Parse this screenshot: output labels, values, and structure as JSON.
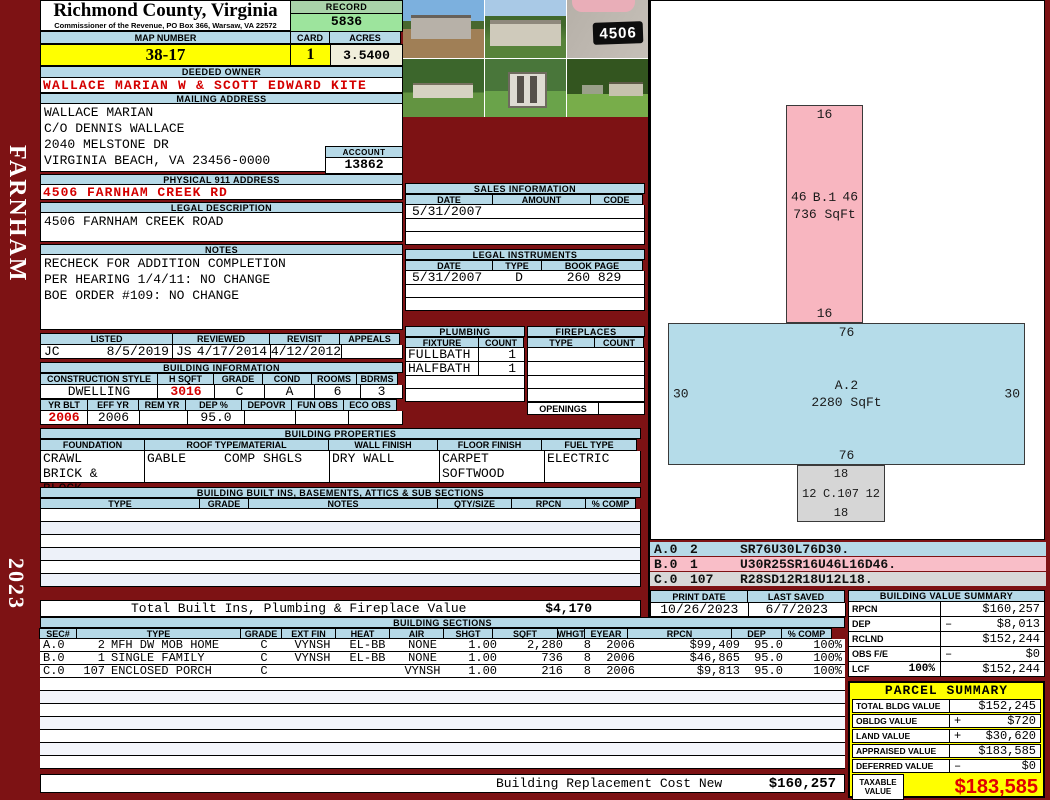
{
  "sidebar": {
    "district": "FARNHAM",
    "year": "2023"
  },
  "header": {
    "county": "Richmond County, Virginia",
    "commissioner": "Commissioner of the Revenue, PO Box 366, Warsaw, VA 22572",
    "record_label": "RECORD",
    "record": "5836",
    "map_number_label": "MAP NUMBER",
    "map_number": "38-17",
    "card_label": "CARD",
    "card": "1",
    "acres_label": "ACRES",
    "acres": "3.5400"
  },
  "owner": {
    "deeded_owner_label": "DEEDED OWNER",
    "deeded_owner": "WALLACE MARIAN W & SCOTT EDWARD KITE",
    "mailing_address_label": "MAILING ADDRESS",
    "mailing_lines": [
      "WALLACE MARIAN",
      "C/O DENNIS WALLACE",
      "2040 MELSTONE DR",
      "VIRGINIA BEACH, VA 23456-0000"
    ],
    "account_label": "ACCOUNT",
    "account": "13862",
    "physical_address_label": "PHYSICAL 911 ADDRESS",
    "physical_address": "4506 FARNHAM CREEK RD",
    "legal_description_label": "LEGAL DESCRIPTION",
    "legal_description": "4506 FARNHAM CREEK ROAD",
    "notes_label": "NOTES",
    "notes": [
      "RECHECK FOR ADDITION COMPLETION",
      "PER HEARING 1/4/11: NO CHANGE",
      "BOE ORDER #109: NO CHANGE"
    ]
  },
  "photos": {
    "sign_number": "4506"
  },
  "sales": {
    "title": "SALES INFORMATION",
    "headers": [
      "DATE",
      "AMOUNT",
      "CODE"
    ],
    "rows": [
      {
        "date": "5/31/2007",
        "amount": "",
        "code": ""
      }
    ]
  },
  "legal_instruments": {
    "title": "LEGAL INSTRUMENTS",
    "headers": [
      "DATE",
      "TYPE",
      "BOOK PAGE"
    ],
    "rows": [
      {
        "date": "5/31/2007",
        "type": "D",
        "book_page": "260 829"
      }
    ]
  },
  "plumbing": {
    "title": "PLUMBING",
    "headers": [
      "FIXTURE",
      "COUNT"
    ],
    "rows": [
      {
        "fixture": "FULLBATH",
        "count": "1"
      },
      {
        "fixture": "HALFBATH",
        "count": "1"
      }
    ]
  },
  "fireplaces": {
    "title": "FIREPLACES",
    "headers": [
      "TYPE",
      "COUNT"
    ],
    "openings_label": "OPENINGS"
  },
  "visits": {
    "headers": [
      "LISTED",
      "REVIEWED",
      "REVISIT",
      "APPEALS"
    ],
    "listed_by": "JC",
    "listed_date": "8/5/2019",
    "reviewed_by": "JS",
    "reviewed_date": "4/17/2014",
    "revisit_date": "4/12/2012",
    "appeals": ""
  },
  "building_info": {
    "title": "BUILDING INFORMATION",
    "row1_headers": [
      "CONSTRUCTION STYLE",
      "H SQFT",
      "GRADE",
      "COND",
      "ROOMS",
      "BDRMS"
    ],
    "style": "DWELLING",
    "hsqft": "3016",
    "grade": "C",
    "cond": "A",
    "rooms": "6",
    "bdrms": "3",
    "row2_headers": [
      "YR BLT",
      "EFF YR",
      "REM YR",
      "DEP %",
      "DEPOVR",
      "FUN OBS",
      "ECO OBS"
    ],
    "yr_blt": "2006",
    "eff_yr": "2006",
    "rem_yr": "",
    "dep_pct": "95.0",
    "depovr": "",
    "fun_obs": "",
    "eco_obs": ""
  },
  "building_properties": {
    "title": "BUILDING PROPERTIES",
    "headers": [
      "FOUNDATION",
      "ROOF TYPE/MATERIAL",
      "WALL FINISH",
      "FLOOR FINISH",
      "FUEL TYPE"
    ],
    "foundation": [
      "CRAWL",
      "BRICK & BLOCK"
    ],
    "roof": [
      "GABLE",
      "COMP SHGLS"
    ],
    "wall": [
      "DRY WALL"
    ],
    "floor": [
      "CARPET",
      "SOFTWOOD"
    ],
    "fuel": [
      "ELECTRIC"
    ]
  },
  "built_ins": {
    "title": "BUILDING BUILT INS, BASEMENTS, ATTICS & SUB SECTIONS",
    "headers": [
      "TYPE",
      "GRADE",
      "NOTES",
      "QTY/SIZE",
      "RPCN",
      "% COMP"
    ],
    "total_label": "Total Built Ins, Plumbing & Fireplace Value",
    "total_value": "$4,170"
  },
  "sketch": {
    "sections": [
      {
        "id": "B.1",
        "area": "736 SqFt",
        "top": "16",
        "bottom": "16",
        "left": "46",
        "right": "46",
        "color": "#f8b6c0"
      },
      {
        "id": "A.2",
        "area": "2280 SqFt",
        "top": "76",
        "bottom": "76",
        "left": "30",
        "right": "30",
        "color": "#b5dce9"
      },
      {
        "id": "C.107",
        "area": "",
        "top": "18",
        "bottom": "18",
        "left": "12",
        "right": "12",
        "color": "#d6d6d6"
      }
    ],
    "legend": [
      {
        "sec": "A.0",
        "num": "2",
        "vector": "SR76U30L76D30."
      },
      {
        "sec": "B.0",
        "num": "1",
        "vector": "U30R25SR16U46L16D46."
      },
      {
        "sec": "C.0",
        "num": "107",
        "vector": "R28SD12R18U12L18."
      }
    ]
  },
  "print_info": {
    "print_date_label": "PRINT DATE",
    "print_date": "10/26/2023",
    "last_saved_label": "LAST SAVED",
    "last_saved": "6/7/2023"
  },
  "building_value_summary": {
    "title": "BUILDING VALUE SUMMARY",
    "rows": [
      {
        "label": "RPCN",
        "pct": "",
        "op": "",
        "value": "$160,257"
      },
      {
        "label": "DEP",
        "pct": "",
        "op": "–",
        "value": "$8,013"
      },
      {
        "label": "RCLND",
        "pct": "",
        "op": "",
        "value": "$152,244"
      },
      {
        "label": "OBS F/E",
        "pct": "",
        "op": "–",
        "value": "$0"
      },
      {
        "label": "LCF",
        "pct": "100%",
        "op": "",
        "value": "$152,244"
      }
    ]
  },
  "building_sections": {
    "title": "BUILDING SECTIONS",
    "headers": [
      "SEC#",
      "TYPE",
      "GRADE",
      "EXT FIN",
      "HEAT",
      "AIR",
      "SHGT",
      "SQFT",
      "WHGT",
      "EYEAR",
      "RPCN",
      "DEP",
      "% COMP"
    ],
    "rows": [
      {
        "sec": "A.0",
        "num": "2",
        "type": "MFH DW MOB HOME",
        "grade": "C",
        "ext_fin": "VYNSH",
        "heat": "EL-BB",
        "air": "NONE",
        "shgt": "1.00",
        "sqft": "2,280",
        "whgt": "8",
        "eyear": "2006",
        "rpcn": "$99,409",
        "dep": "95.0",
        "comp": "100%"
      },
      {
        "sec": "B.0",
        "num": "1",
        "type": "SINGLE FAMILY",
        "grade": "C",
        "ext_fin": "VYNSH",
        "heat": "EL-BB",
        "air": "NONE",
        "shgt": "1.00",
        "sqft": "736",
        "whgt": "8",
        "eyear": "2006",
        "rpcn": "$46,865",
        "dep": "95.0",
        "comp": "100%"
      },
      {
        "sec": "C.0",
        "num": "107",
        "type": "ENCLOSED PORCH",
        "grade": "C",
        "ext_fin": "VYNSH",
        "heat": "",
        "air": "",
        "shgt": "1.00",
        "sqft": "216",
        "whgt": "8",
        "eyear": "2006",
        "rpcn": "$9,813",
        "dep": "95.0",
        "comp": "100%"
      }
    ],
    "footer_label": "Building Replacement Cost New",
    "footer_value": "$160,257"
  },
  "parcel_summary": {
    "title": "PARCEL SUMMARY",
    "rows": [
      {
        "label": "TOTAL BLDG VALUE",
        "op": "",
        "value": "$152,245"
      },
      {
        "label": "OBLDG VALUE",
        "op": "+",
        "value": "$720"
      },
      {
        "label": "LAND VALUE",
        "op": "+",
        "value": "$30,620"
      },
      {
        "label": "APPRAISED VALUE",
        "op": "",
        "value": "$183,585"
      },
      {
        "label": "DEFERRED VALUE",
        "op": "–",
        "value": "$0"
      }
    ],
    "taxable_label": "TAXABLE VALUE",
    "taxable_value": "$183,585"
  },
  "colors": {
    "frame": "#7d1214",
    "banner_blue": "#b6d9e7",
    "record_green": "#9de49d",
    "highlight_yellow": "#ffff00",
    "value_red": "#d40000",
    "sketch_pink": "#f8b6c0",
    "sketch_blue": "#b5dce9",
    "sketch_gray": "#d6d6d6"
  }
}
